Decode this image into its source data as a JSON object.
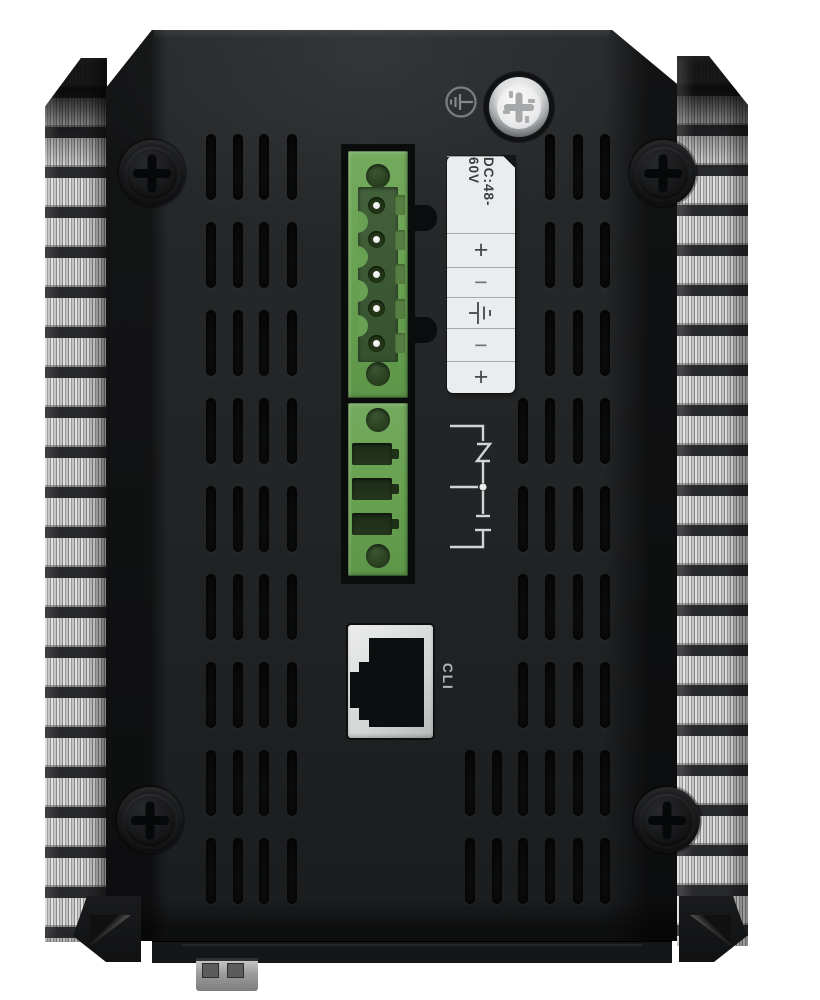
{
  "image": {
    "subject": "Rear panel of a black industrial device with side heatsink fins, pluggable power terminal, relay output block, grounding screw and RJ45 console port"
  },
  "power_label": {
    "rating": "DC:48-60V",
    "terminals": [
      "+",
      "−",
      "⏚",
      "−",
      "+"
    ],
    "terminal_names": [
      "positive",
      "negative",
      "earth-ground",
      "negative",
      "positive"
    ]
  },
  "console_port": {
    "label": "CLI"
  },
  "colors": {
    "body": "#1f2123",
    "terminal_green": "#6ba257",
    "label_background": "#ebeced",
    "fin_metal": "#c9c9c9",
    "port_face": "#dcdddd"
  }
}
